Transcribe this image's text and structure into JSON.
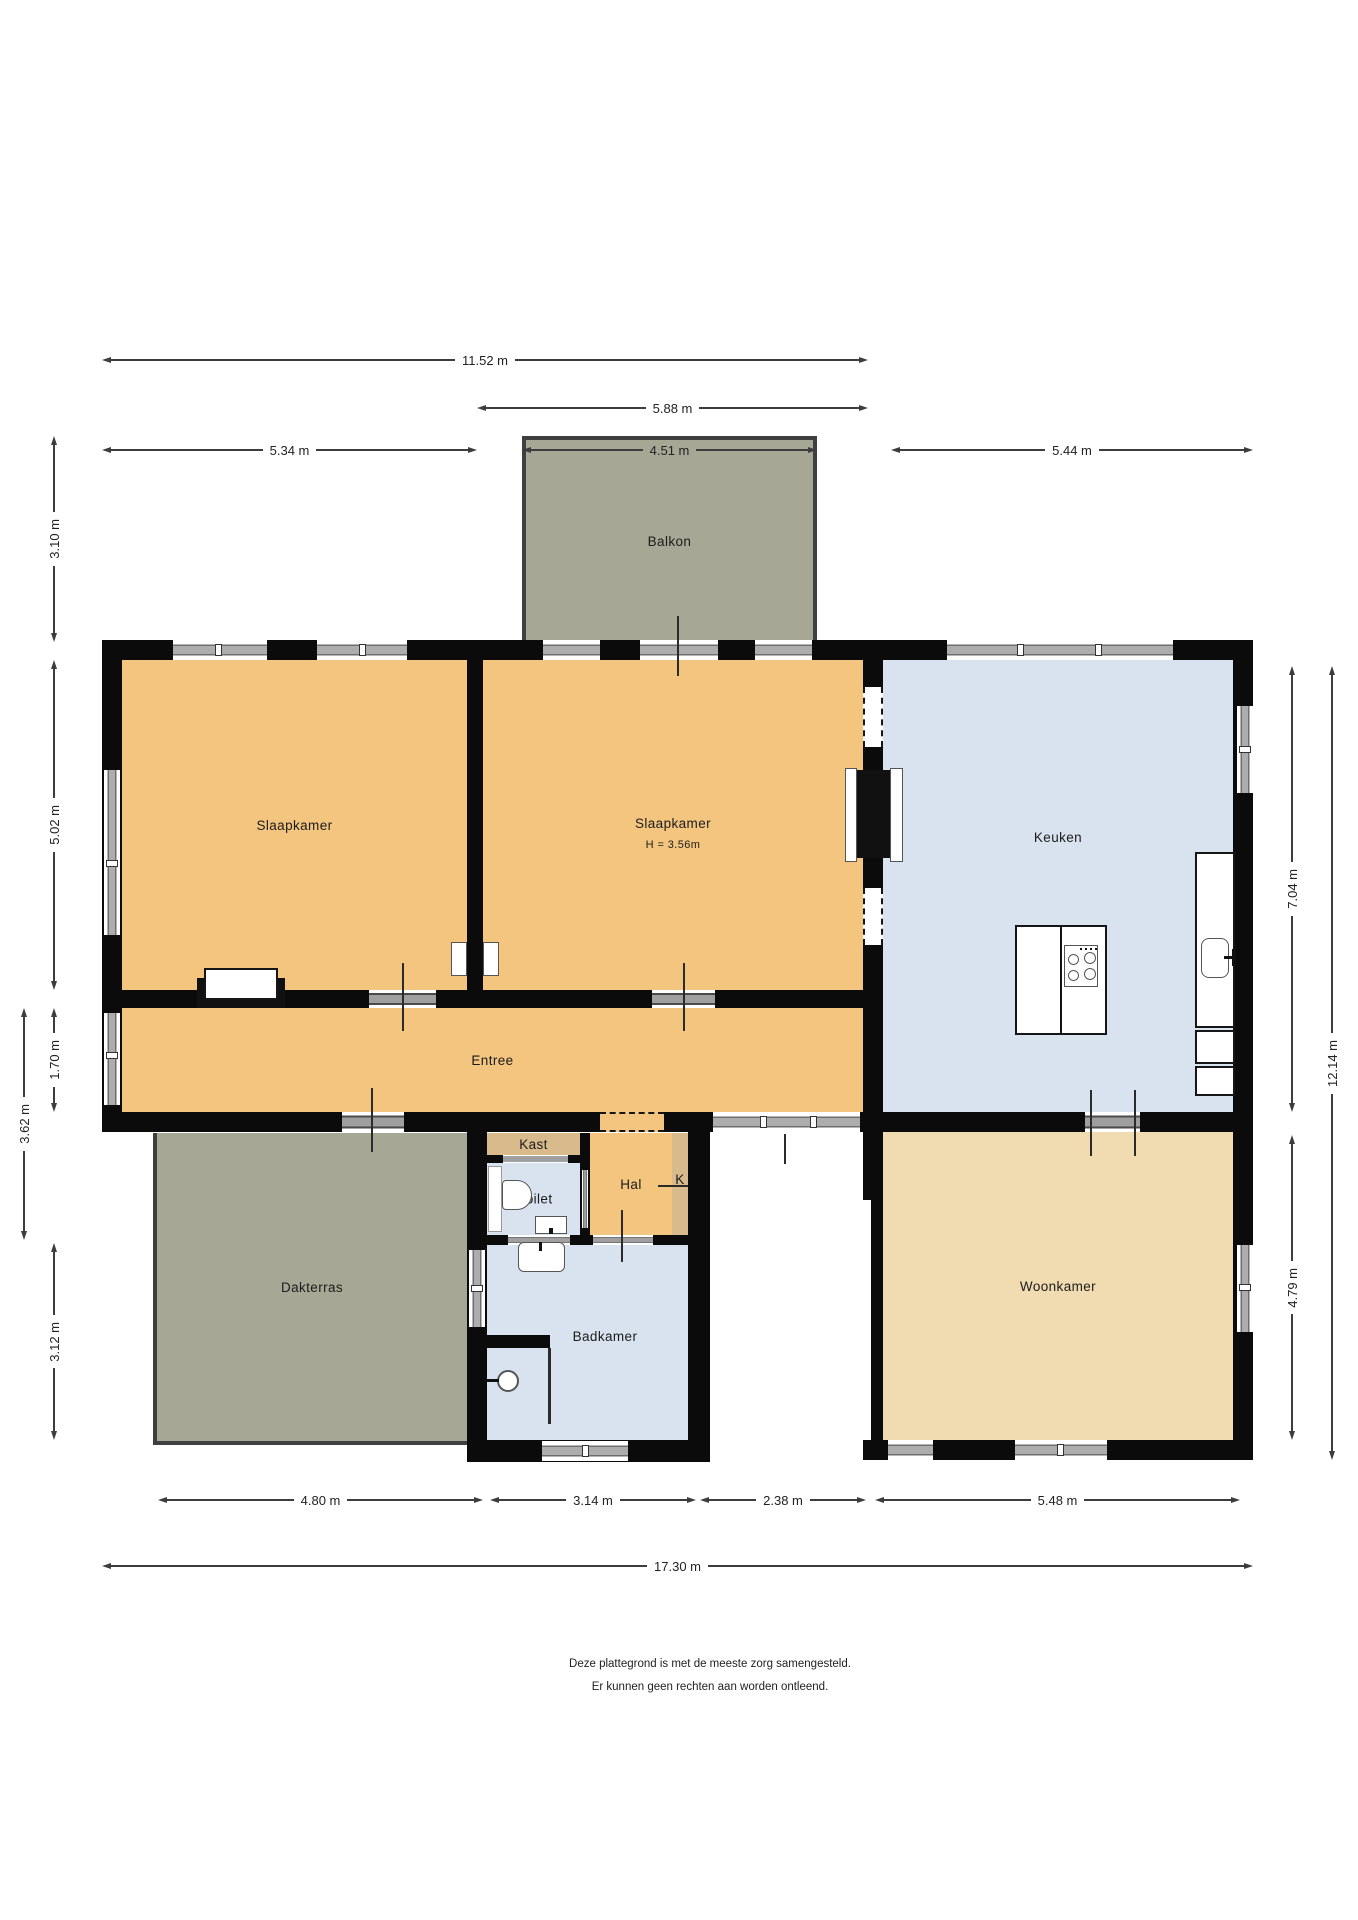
{
  "rooms": {
    "balkon": {
      "label": "Balkon"
    },
    "slaapkamer_links": {
      "label": "Slaapkamer"
    },
    "slaapkamer_midden": {
      "label": "Slaapkamer",
      "sub": "H = 3.56m"
    },
    "keuken": {
      "label": "Keuken"
    },
    "entree": {
      "label": "Entree"
    },
    "dakterras": {
      "label": "Dakterras"
    },
    "kast": {
      "label": "Kast"
    },
    "toilet": {
      "label": "Toilet"
    },
    "hal": {
      "label": "Hal"
    },
    "kast_k": {
      "label": "K"
    },
    "badkamer": {
      "label": "Badkamer"
    },
    "woonkamer": {
      "label": "Woonkamer"
    }
  },
  "dimensions": {
    "top": [
      {
        "label": "11.52 m"
      },
      {
        "label": "5.88 m"
      },
      {
        "label": "5.34 m"
      },
      {
        "label": "4.51 m"
      },
      {
        "label": "5.44 m"
      }
    ],
    "left": [
      {
        "label": "3.10 m"
      },
      {
        "label": "5.02 m"
      },
      {
        "label": "1.70 m"
      },
      {
        "label": "3.62 m"
      },
      {
        "label": "3.12 m"
      }
    ],
    "right": [
      {
        "label": "7.04 m"
      },
      {
        "label": "12.14 m"
      },
      {
        "label": "4.79 m"
      }
    ],
    "bottom": [
      {
        "label": "4.80 m"
      },
      {
        "label": "3.14 m"
      },
      {
        "label": "2.38 m"
      },
      {
        "label": "5.48 m"
      },
      {
        "label": "17.30 m"
      }
    ]
  },
  "disclaimer": {
    "line1": "Deze plattegrond is met de meeste zorg samengesteld.",
    "line2": "Er kunnen geen rechten aan worden ontleend."
  },
  "colors": {
    "orange": "#F4C57E",
    "tan": "#D9BA8C",
    "cream": "#F1DCB2",
    "blue": "#D8E3EF",
    "green": "#A6A795",
    "wall": "#0B0B0B",
    "frame": "#6E6E6E",
    "glass": "#ADADAD"
  }
}
